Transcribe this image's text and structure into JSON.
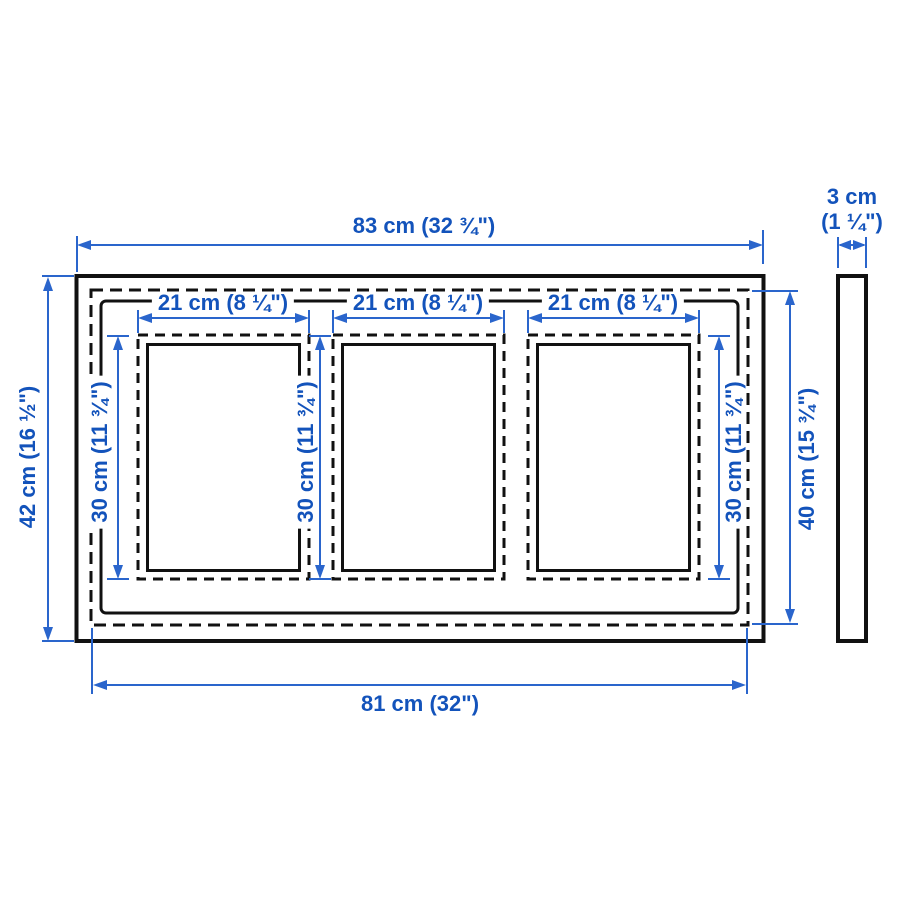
{
  "diagram": {
    "kind": "product-dimension-diagram",
    "subject": "picture frame for 3 photos, front view with side profile",
    "colors": {
      "dimension_text_blue": "#1353bb",
      "dimension_line_blue": "#2a65cc",
      "line_art_black": "#111111",
      "background": "#ffffff"
    },
    "overall": {
      "width_label": "83 cm (32 ¾\")",
      "height_label": "42 cm (16 ½\")"
    },
    "inner": {
      "width_label": "81 cm (32\")",
      "height_label": "40 cm (15 ¾\")"
    },
    "depth": {
      "line1": "3 cm",
      "line2": "(1 ¼\")"
    },
    "openings": [
      {
        "width_label": "21 cm (8 ¼\")",
        "height_label": "30 cm (11 ¾\")"
      },
      {
        "width_label": "21 cm (8 ¼\")",
        "height_label": "30 cm (11 ¾\")"
      },
      {
        "width_label": "21 cm (8 ¼\")",
        "height_label": "30 cm (11 ¾\")"
      }
    ]
  }
}
